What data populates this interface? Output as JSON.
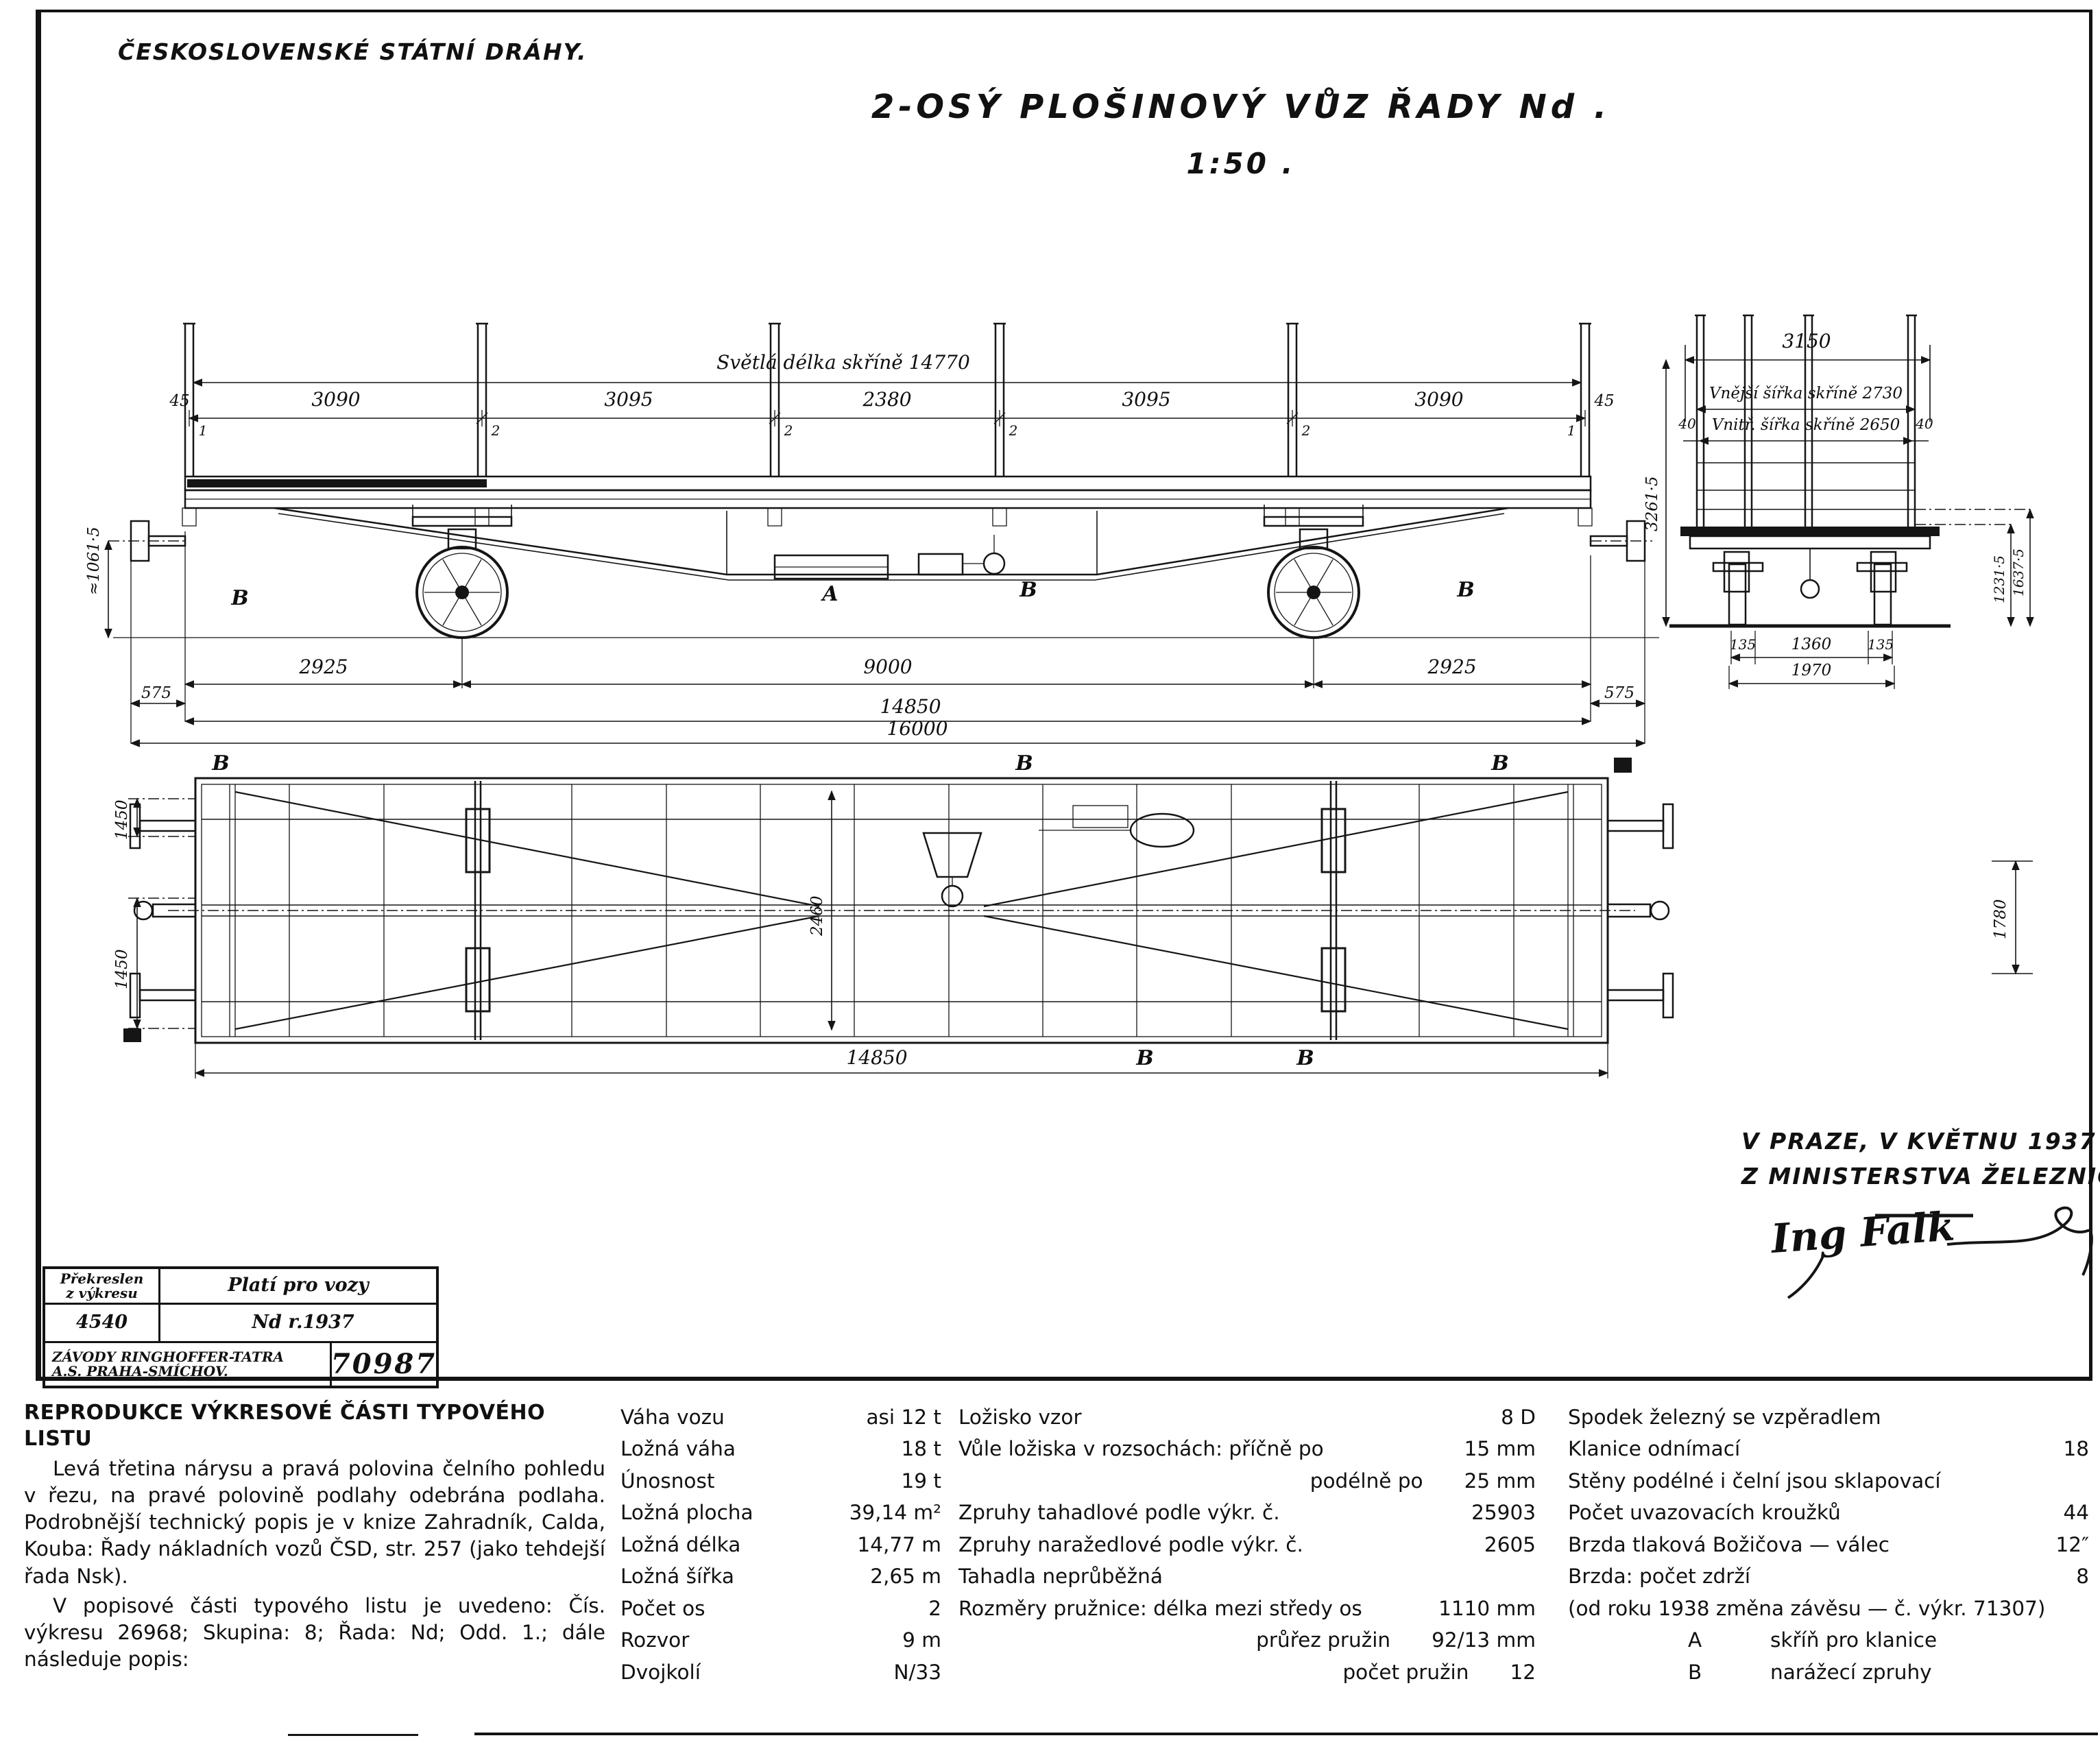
{
  "header": {
    "org": "ČESKOSLOVENSKÉ STÁTNÍ DRÁHY.",
    "title": "2-OSÝ PLOŠINOVÝ VŮZ ŘADY Nd .",
    "scale": "1:50 ."
  },
  "side_view": {
    "clear_length_label": "Světlá délka skříně 14770",
    "overhang_left": "45",
    "overhang_right": "45",
    "segments": [
      "3090",
      "3095",
      "2380",
      "3095",
      "3090"
    ],
    "boundary_marks": [
      "1",
      "2",
      "2",
      "2",
      "2",
      "1"
    ],
    "under_dims": [
      "2925",
      "9000",
      "2925"
    ],
    "buffer_overhang_left": "575",
    "buffer_overhang_right": "575",
    "body_length": "14850",
    "total_length": "16000",
    "buffer_height": "≈1061·5",
    "letter_a": "A",
    "letter_b": "B"
  },
  "end_view": {
    "top_width": "3150",
    "outer_width_label": "Vnější šířka skříně 2730",
    "inner_width_label": "Vnitř. šířka skříně 2650",
    "wall_thickness_left": "40",
    "wall_thickness_right": "40",
    "height_total": "3261·5",
    "height_floor": "1231·5",
    "height_wall": "1637·5",
    "lower_dims": [
      "135",
      "1360",
      "135"
    ],
    "lower_span": "1970"
  },
  "plan_view": {
    "half_width_top": "1450",
    "half_width_bottom": "1450",
    "body_length": "14850",
    "right_dim": "1780",
    "center_dim": "2460",
    "letter_b": "B"
  },
  "signature": {
    "line1": "V PRAZE, V KVĚTNU 1937 .",
    "line2": "Z MINISTERSTVA ŽELEZNIC :",
    "name": "Ing Falk"
  },
  "stamp": {
    "r1c1a": "Překreslen",
    "r1c1b": "z výkresu",
    "r1c2": "Platí pro vozy",
    "r2c1": "4540",
    "r2c2": "Nd r.1937",
    "r3c1a": "ZÁVODY RINGHOFFER-TATRA",
    "r3c1b": "A.S. PRAHA-SMÍCHOV.",
    "r3c2": "70987"
  },
  "notes": {
    "heading": "REPRODUKCE VÝKRESOVÉ ČÁSTI TYPOVÉHO LISTU",
    "para1": "Levá třetina nárysu a pravá polovina čelního pohledu v řezu, na pravé polovině podlahy odebrána podlaha. Podrobnější technický popis je v knize Zahradník, Calda, Kouba: Řady nákladních vozů ČSD, str. 257 (jako tehdejší řada Nsk).",
    "para2": "V popisové části typového listu je uvedeno: Čís. výkresu 26968; Skupina: 8; Řada: Nd; Odd. 1.; dále následuje popis:"
  },
  "specs": {
    "col1": {
      "rows": [
        {
          "label": "Váha vozu",
          "value": "asi 12 t"
        },
        {
          "label": "Ložná váha",
          "value": "18 t"
        },
        {
          "label": "Únosnost",
          "value": "19 t"
        },
        {
          "label": "Ložná plocha",
          "value": "39,14 m²"
        },
        {
          "label": "Ložná délka",
          "value": "14,77 m"
        },
        {
          "label": "Ložná šířka",
          "value": "2,65 m"
        },
        {
          "label": "Počet os",
          "value": "2"
        },
        {
          "label": "Rozvor",
          "value": "9 m"
        },
        {
          "label": "Dvojkolí",
          "value": "N/33"
        }
      ]
    },
    "col2": {
      "rows": [
        {
          "label": "Ložisko vzor",
          "value": "8 D"
        },
        {
          "label": "Vůle ložiska v rozsochách: příčně po",
          "value": "15 mm"
        },
        {
          "label": "podélně po",
          "value": "25 mm"
        },
        {
          "label": "Zpruhy tahadlové podle výkr. č.",
          "value": "25903"
        },
        {
          "label": "Zpruhy naražedlové podle výkr. č.",
          "value": "2605"
        },
        {
          "label": "Tahadla neprůběžná",
          "value": ""
        },
        {
          "label": "Rozměry pružnice: délka mezi středy os",
          "value": "1110 mm"
        },
        {
          "label": "průřez pružin",
          "value": "92/13 mm"
        },
        {
          "label": "počet pružin",
          "value": "12"
        }
      ]
    },
    "col3": {
      "rows": [
        {
          "label": "Spodek železný se vzpěradlem",
          "value": ""
        },
        {
          "label": "Klanice odnímací",
          "value": "18"
        },
        {
          "label": "Stěny podélné i čelní jsou sklapovací",
          "value": ""
        },
        {
          "label": "Počet uvazovacích kroužků",
          "value": "44"
        },
        {
          "label": "Brzda tlaková Božičova — válec",
          "value": "12″"
        },
        {
          "label": "Brzda: počet zdrží",
          "value": "8"
        },
        {
          "label": "(od roku 1938 změna závěsu — č. výkr. 71307)",
          "value": ""
        },
        {
          "label": "A",
          "value": "skříň pro klanice"
        },
        {
          "label": "B",
          "value": "narážecí zpruhy"
        }
      ]
    }
  }
}
